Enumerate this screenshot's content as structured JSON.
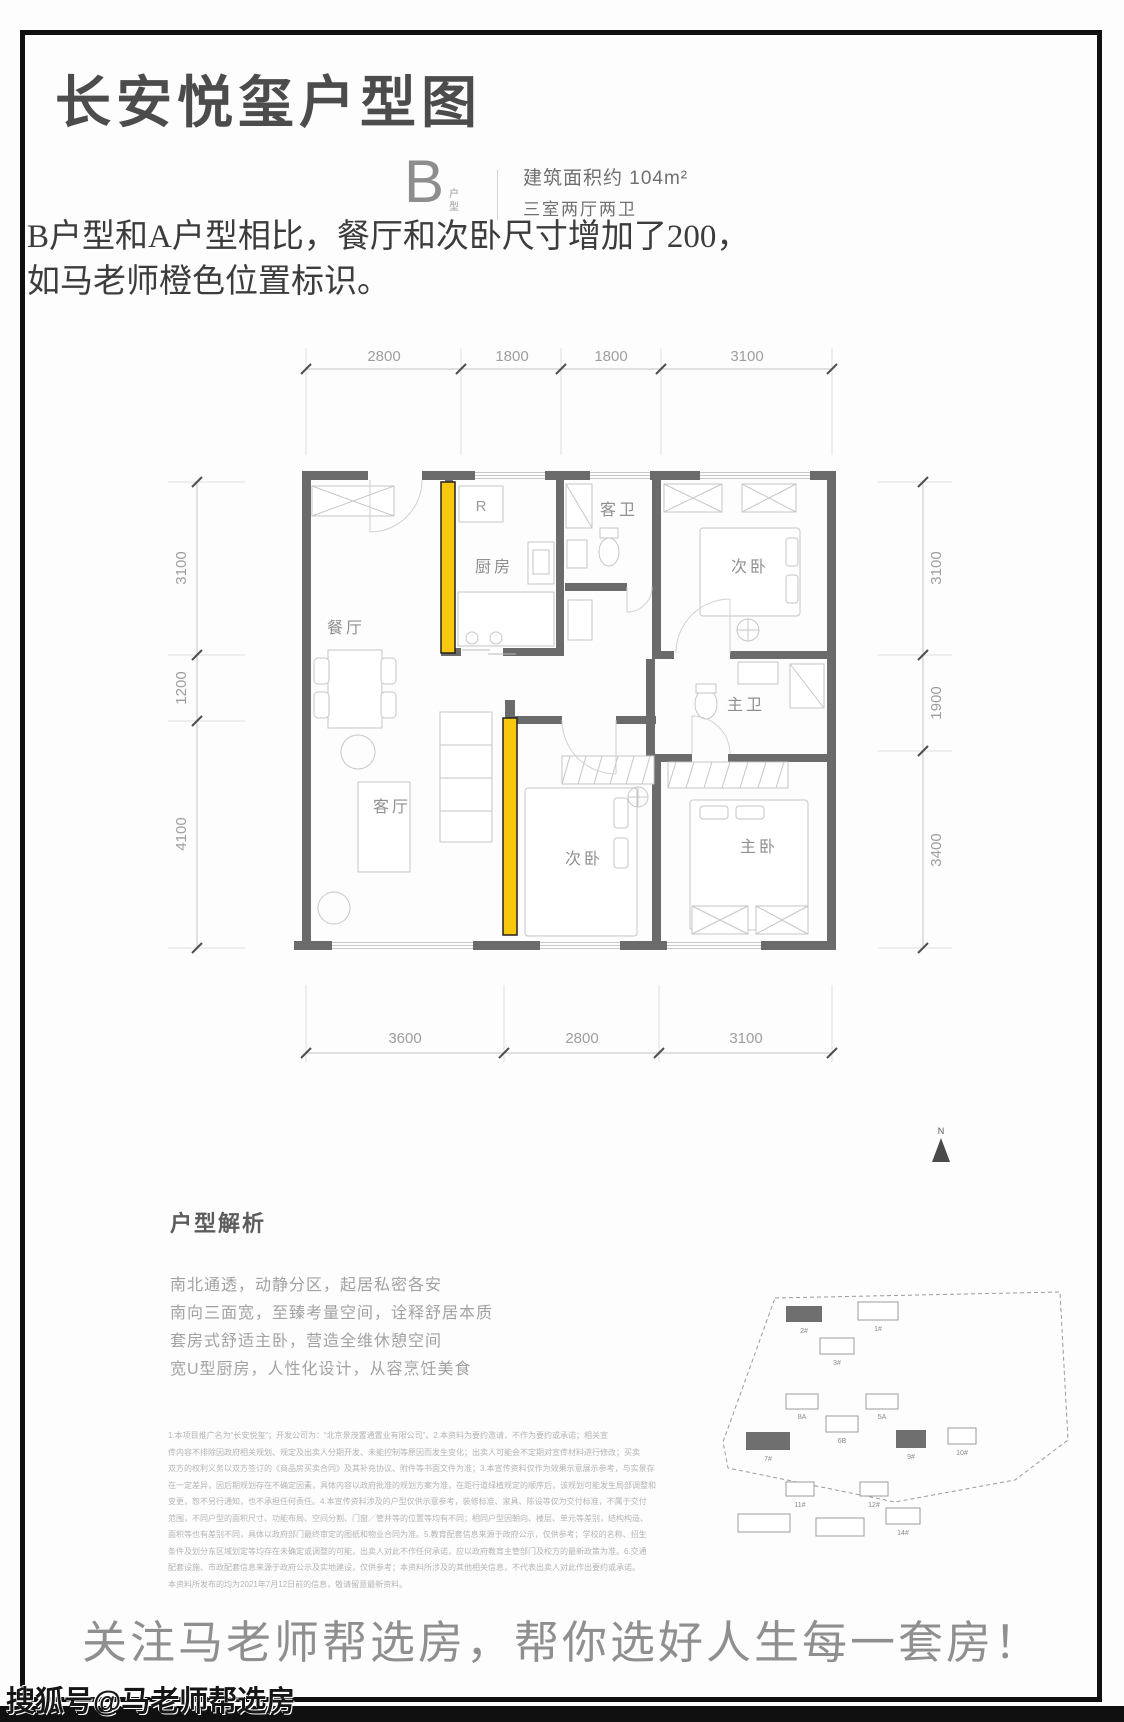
{
  "header": {
    "title": "长安悦玺户型图",
    "unit_letter": "B",
    "unit_label": "户型",
    "area": "建筑面积约 104m²",
    "rooms_summary": "三室两厅两卫",
    "note_line1": "B户型和A户型相比，餐厅和次卧尺寸增加了200，",
    "note_line2": "如马老师橙色位置标识。"
  },
  "floorplan": {
    "highlight_color": "#f9c80e",
    "wall_color": "#6b6b6b",
    "fridge": "R",
    "rooms": {
      "dining": "餐厅",
      "kitchen": "厨房",
      "guest_bath": "客卫",
      "bedroom_top": "次卧",
      "living": "客厅",
      "bedroom_mid": "次卧",
      "master_bath": "主卫",
      "master_bedroom": "主卧"
    },
    "dims": {
      "top": [
        "2800",
        "1800",
        "1800",
        "3100"
      ],
      "left": [
        "3100",
        "1200",
        "4100"
      ],
      "right": [
        "3100",
        "1900",
        "3400"
      ],
      "bottom": [
        "3600",
        "2800",
        "3100"
      ]
    }
  },
  "analysis": {
    "heading": "户型解析",
    "points": [
      "南北通透，动静分区，起居私密各安",
      "南向三面宽，至臻考量空间，诠释舒居本质",
      "套房式舒适主卧，营造全维休憩空间",
      "宽U型厨房，人性化设计，从容烹饪美食"
    ],
    "disclaimer_lines": [
      "1.本项目推广名为“长安悦玺”；开发公司为：“北京景茂置通置业有限公司”。2.本资料为要约邀请，不作为要约或承诺；相关宣",
      "传内容不排除因政府相关规划、规定及出卖人分期开发、未能控制等原因而发生变化；出卖人可能会不定期对宣传材料进行修改；买卖",
      "双方的权利义务以双方签订的《商品房买卖合同》及其补充协议、附件等书面文件为准；3.本宣传资料仅作为效果示意展示参考，与实景存",
      "在一定差异，因后期规划存在不确定因素，具体内容以政府批准的规划方案为准，在距行道绿植规定的顺序后，该规划可能发生局部调整和",
      "变更，恕不另行通知，也不承担任何责任。4.本宣传资料涉及的户型仅供示意参考，装修标准、家具、陈设等仅为交付标准，不属于交付",
      "范围，不同户型的面积尺寸、功能布局、空间分割、门窗／管井等的位置等均有不同；相同户型因朝向、楼层、单元等差别，结构构造、",
      "面积等也有差别不同，具体以政府部门最终审定的图纸和物业合同为准。5.教育配套信息来源于政府公示，仅供参考；学校的名称、招生",
      "条件及划分东区域划定等均存在未确定或调整的可能，出卖人对此不作任何承诺，应以政府教育主管部门及校方的最新政策为准。6.交通",
      "配套设施、市政配套信息来源于政府公示及实地建设，仅供参考；本资料所涉及的其他相关信息，不代表出卖人对此作出要约或承诺。",
      "本资料所发布的均为2021年7月12日前的信息，敬请留意最新资料。"
    ]
  },
  "siteplan": {
    "north": "N",
    "buildings": [
      {
        "label": "2#",
        "dark": true
      },
      {
        "label": "1#",
        "dark": false
      },
      {
        "label": "3#",
        "dark": false
      },
      {
        "label": "8A",
        "dark": false
      },
      {
        "label": "5A",
        "dark": false
      },
      {
        "label": "6B",
        "dark": false
      },
      {
        "label": "7#",
        "dark": true
      },
      {
        "label": "9#",
        "dark": true
      },
      {
        "label": "11#",
        "dark": false
      },
      {
        "label": "12#",
        "dark": false
      },
      {
        "label": "13#",
        "dark": false
      },
      {
        "label": "13#",
        "dark": false
      },
      {
        "label": "14#",
        "dark": false
      },
      {
        "label": "10#",
        "dark": false
      }
    ]
  },
  "footer": {
    "slogan": "关注马老师帮选房，帮你选好人生每一套房！",
    "watermark": "搜狐号@马老师帮选房"
  }
}
